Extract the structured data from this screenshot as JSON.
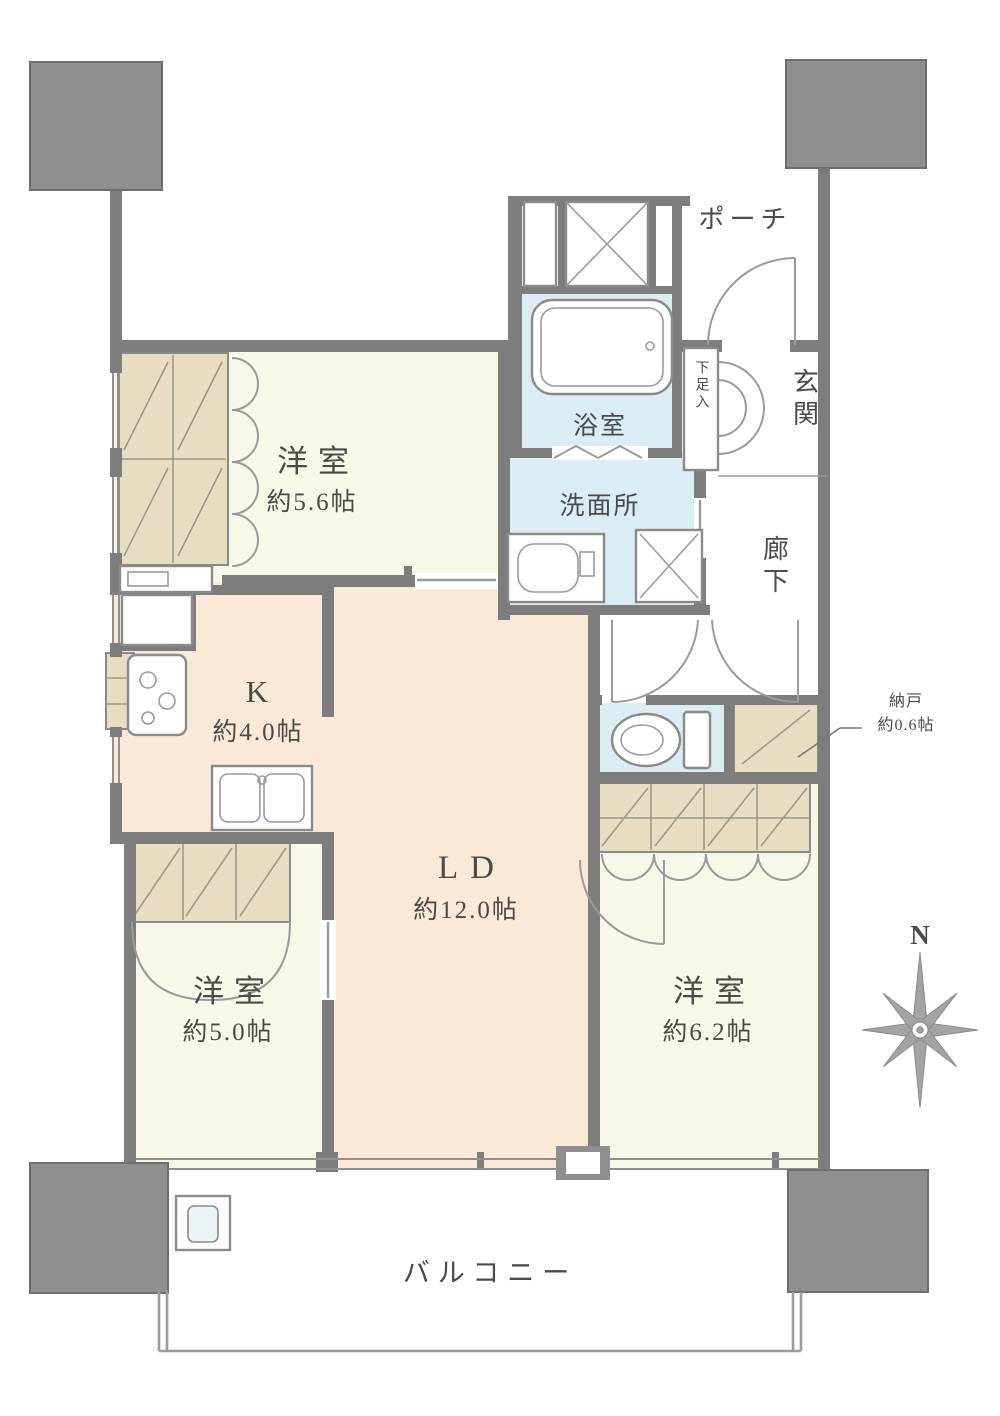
{
  "plan": {
    "labels": {
      "porch": "ポーチ",
      "entrance": "玄関",
      "shoe_box": "下足入",
      "bath": "浴室",
      "washroom": "洗面所",
      "corridor": "廊下",
      "storage_name": "納戸",
      "storage_size": "約0.6帖",
      "balcony": "バルコニー",
      "compass_n": "N"
    },
    "rooms": {
      "western1": {
        "name": "洋室",
        "size": "約5.6帖"
      },
      "kitchen": {
        "name": "K",
        "size": "約4.0帖"
      },
      "living": {
        "name": "LD",
        "size": "約12.0帖"
      },
      "western2": {
        "name": "洋室",
        "size": "約5.0帖"
      },
      "western3": {
        "name": "洋室",
        "size": "約6.2帖"
      }
    },
    "colors": {
      "wall": "#7d7d7d",
      "pillar": "#8f8f8f",
      "room_cream": "#f8f7e8",
      "room_peach": "#fbe9d7",
      "room_blue": "#d9edf2",
      "closet_tan": "#e9ddc1",
      "text": "#4a4a4a"
    }
  }
}
